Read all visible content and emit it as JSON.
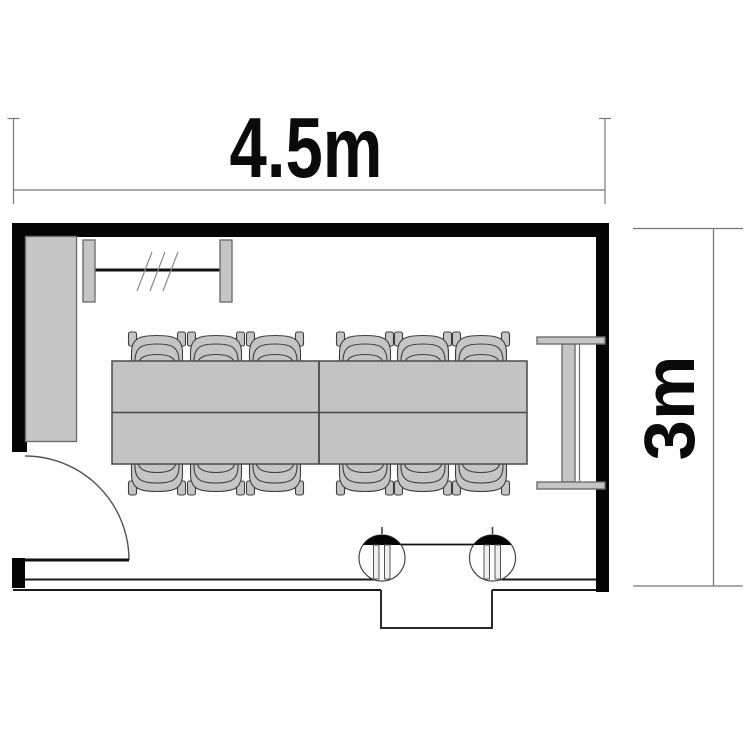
{
  "diagram_type": "room floor plan",
  "dimension_labels": {
    "top": "4.5m",
    "right": "3m"
  },
  "objects": [
    {
      "name": "conference-table",
      "count": 2
    },
    {
      "name": "chair",
      "count": 12
    },
    {
      "name": "storage-cabinet",
      "count": 1
    },
    {
      "name": "wall-mounted-board",
      "count": 1
    },
    {
      "name": "side-partition",
      "count": 1
    },
    {
      "name": "swing-door",
      "count": 1
    },
    {
      "name": "entrance-column",
      "count": 2
    },
    {
      "name": "entrance-alcove",
      "count": 1
    }
  ],
  "colors": {
    "background": "#ffffff",
    "wall": "#000000",
    "furniture_fill": "#c5c5c5",
    "furniture_outline": "#3d3d3d",
    "dimension_line": "#777777",
    "label_text": "#0a0a0a"
  }
}
